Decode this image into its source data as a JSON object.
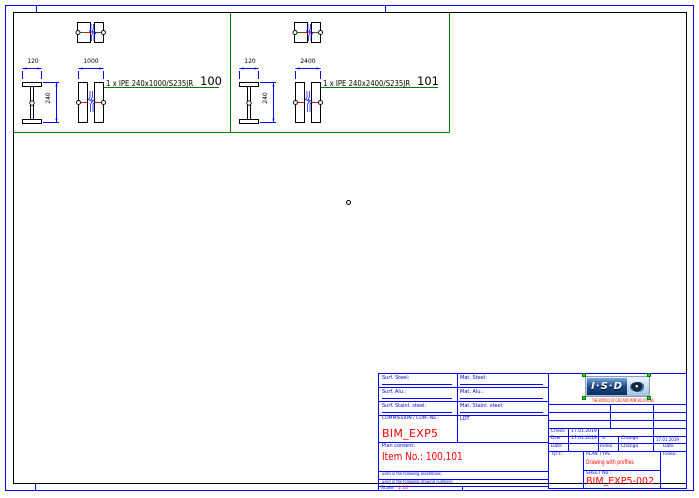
{
  "sheet": {
    "panels": [
      {
        "profile_label": "1 x IPE 240x1000/S235JR",
        "item_no": "100",
        "dim_width": "120",
        "dim_height": "240",
        "dim_length": "1000"
      },
      {
        "profile_label": "1 x IPE 240x2400/S235JR",
        "item_no": "101",
        "dim_width": "120",
        "dim_height": "240",
        "dim_length": "2400"
      }
    ]
  },
  "title_block": {
    "surf_steel_label": "Surf. Steel:",
    "mat_steel_label": "Mat. Steel:",
    "surf_alu_label": "Surf. Alu.:",
    "mat_alu_label": "Mat. Alu.:",
    "surf_stainless_label": "Surf. Stainl. steel:",
    "mat_stainless_label": "Mat. Stainl. steel:",
    "commission_label": "COMMISSION / COM.-No.:",
    "commission_value": "BIM_EXP5",
    "lot_label": "LOT",
    "plan_content_label": "Plan content:",
    "plan_content_value": "Item No.: 100,101",
    "assemblies_note": "used in the following assemblies:",
    "drawing_numbers_note": "used in the following drawing numbers:",
    "scale_label": "Scale:",
    "scale_value": "1:10",
    "check_label": "Check",
    "check_date": "17.01.2019",
    "drawn_label": "Drw",
    "drawn_date": "17.01.2019",
    "date_label": "Date",
    "revision_index_value": "a",
    "revision_change_value": "Change",
    "revision_date_value": "17.01.2019",
    "index_header": "Index",
    "change_header": "Change",
    "date_header": "Date",
    "qty_label": "QTY.:",
    "plan_type_label": "PLAN TYPE:",
    "plan_type_value": "Drawing with profiles",
    "sheet_no_label": "SHEET No.:",
    "sheet_no_value": "BIM_EXP5-002",
    "index_label": "Index:",
    "logo_text": "I·S·D",
    "logo_subtitle": "THE WORLD OF CAD AND PDM SOLUTIONS"
  },
  "colors": {
    "line_blue": "#0000ff",
    "cad_green": "#008000",
    "cad_red": "#ff0000",
    "text_blue": "#0000dd",
    "black": "#000000"
  }
}
